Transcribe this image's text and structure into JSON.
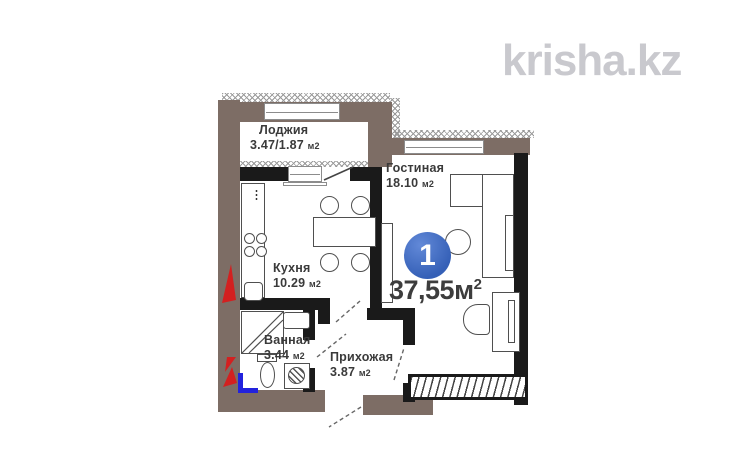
{
  "watermark": {
    "text": "krisha.kz"
  },
  "badge": {
    "number": "1",
    "area": "37,55",
    "unit": "м",
    "sup": "2"
  },
  "rooms": [
    {
      "name": "Лоджия",
      "area": "3.47/1.87",
      "unit": "м2"
    },
    {
      "name": "Гостиная",
      "area": "18.10",
      "unit": "м2"
    },
    {
      "name": "Кухня",
      "area": "10.29",
      "unit": "м2"
    },
    {
      "name": "Ванная",
      "area": "3.44",
      "unit": "м2"
    },
    {
      "name": "Прихожая",
      "area": "3.87",
      "unit": "м2"
    }
  ],
  "colors": {
    "accent_blue": "#3560b7",
    "wall_brown": "#7d6d65",
    "wall_black": "#1a1a1a",
    "hatch_gray": "#9a9a9a",
    "furniture_line": "#4f4f4f",
    "red": "#d32020",
    "pipe_blue": "#2222dd",
    "watermark_gray": "#c9c9ce",
    "text": "#3a3a3a"
  }
}
